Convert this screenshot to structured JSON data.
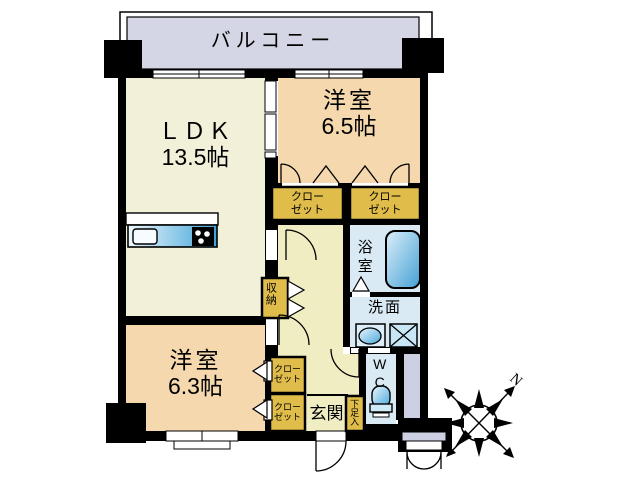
{
  "rooms": {
    "balcony": {
      "label": "バルコニー"
    },
    "ldk": {
      "label": "ＬＤＫ",
      "size": "13.5帖"
    },
    "bedroom_65": {
      "label": "洋室",
      "size": "6.5帖"
    },
    "bedroom_63": {
      "label": "洋室",
      "size": "6.3帖"
    },
    "bath": {
      "label": "浴室"
    },
    "washroom": {
      "label": "洗面"
    },
    "wc": {
      "label": "WC"
    },
    "entrance": {
      "label": "玄関"
    },
    "storage": {
      "label": "収納"
    },
    "shoe_cabinet": {
      "label": "下足入"
    },
    "closet": {
      "line1": "クロー",
      "line2": "ゼット"
    }
  },
  "compass": {
    "north_label": "N"
  },
  "colors": {
    "wall": "#000000",
    "balcony_fill": "#d4d6e5",
    "ldk_fill": "#f2f0d8",
    "bedroom_fill": "#f5d8ae",
    "hall_fill": "#f1edc2",
    "closet_fill": "#e0bd4a",
    "wet_fill": "#d9eaf4",
    "ps_fill": "#ccd0e2",
    "fixture_blue": "#4aa8dc"
  }
}
